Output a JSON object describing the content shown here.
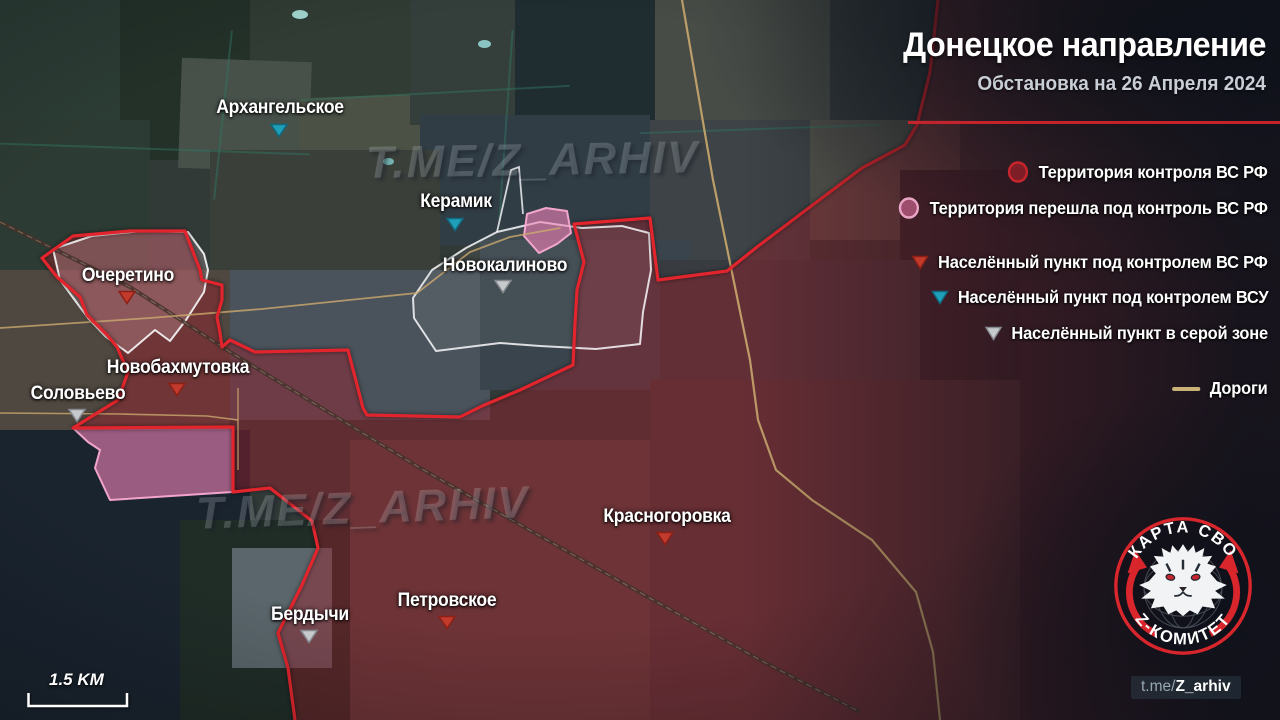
{
  "header": {
    "title": "Донецкое направление",
    "subtitle": "Обстановка на 26 Апреля 2024"
  },
  "legend": {
    "items": [
      {
        "id": "rf-territory",
        "label": "Территория контроля ВС РФ",
        "marker": "circle",
        "fill": "#8e1f28",
        "stroke": "#c8242c"
      },
      {
        "id": "rf-new-territory",
        "label": "Территория перешла под контроль ВС РФ",
        "marker": "circle",
        "fill": "#b75a80",
        "stroke": "#eaa6c6"
      },
      {
        "id": "rf-settlement",
        "label": "Населённый пункт под контролем ВС РФ",
        "marker": "triangle",
        "fill": "#c23a2b",
        "stroke": "#8c1f16"
      },
      {
        "id": "afu-settlement",
        "label": "Населённый пункт под контролем ВСУ",
        "marker": "triangle",
        "fill": "#1f9fb8",
        "stroke": "#0f6a80"
      },
      {
        "id": "gray-zone-settlement",
        "label": "Населённый пункт в серой зоне",
        "marker": "triangle",
        "fill": "#c7cacd",
        "stroke": "#85898e"
      },
      {
        "id": "roads",
        "label": "Дороги",
        "marker": "line",
        "fill": "#c9b178"
      }
    ]
  },
  "towns": [
    {
      "name": "Архангельское",
      "control": "afu"
    },
    {
      "name": "Керамик",
      "control": "afu"
    },
    {
      "name": "Новокалиново",
      "control": "gray"
    },
    {
      "name": "Очеретино",
      "control": "rf"
    },
    {
      "name": "Новобахмутовка",
      "control": "rf"
    },
    {
      "name": "Соловьево",
      "control": "gray"
    },
    {
      "name": "Красногоровка",
      "control": "rf"
    },
    {
      "name": "Петровское",
      "control": "rf"
    },
    {
      "name": "Бердычи",
      "control": "gray"
    }
  ],
  "watermark": {
    "text": "T.ME/Z_ARHIV"
  },
  "scale_bar": {
    "label": "1.5 KM"
  },
  "logo": {
    "arc_top": "КАРТА СВО",
    "arc_bottom": "Z-КОМИТЕТ"
  },
  "handle": {
    "prefix": "t.me/",
    "name": "Z_arhiv"
  },
  "colors": {
    "front_line": "#e2242c",
    "rf_fill": "rgba(160,30,42,0.42)",
    "captured_fill": "rgba(242,130,185,0.6)",
    "road": "#c9b178"
  }
}
